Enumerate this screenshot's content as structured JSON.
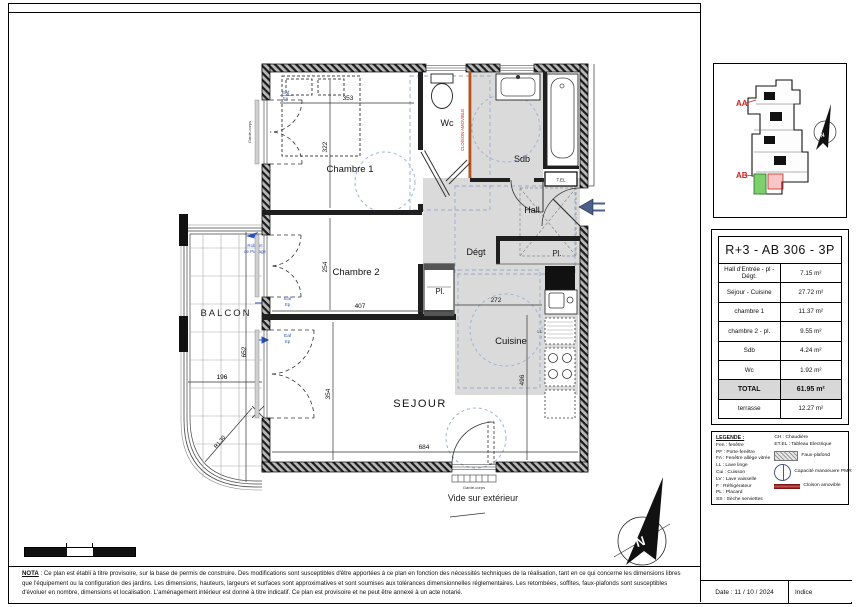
{
  "plan": {
    "rooms": {
      "chambre1": "Chambre 1",
      "chambre2": "Chambre 2",
      "wc": "Wc",
      "sdb": "Sdb",
      "hall": "Hall",
      "degt": "Dégt",
      "cuisine": "Cuisine",
      "sejour": "SEJOUR",
      "balcon": "BALCON",
      "placard": "Pl."
    },
    "dims": {
      "d353": "353",
      "d322": "322",
      "d254": "254",
      "d407": "407",
      "d272": "272",
      "d496": "496",
      "d354": "354",
      "d684": "684",
      "d652": "652",
      "d196": "196",
      "radius": "R1.30"
    },
    "annotations": {
      "vide": "Vide sur extérieur",
      "garde_corps": "Garde-corps",
      "cloison": "CLOISON AMOVIBLE",
      "robinet_l1": "Robinet",
      "robinet_l2": "de Puisage",
      "eaf": "Eaf",
      "ep": "Ep",
      "tel": "T.EL",
      "ll": "LL",
      "north": "N"
    }
  },
  "key_plan": {
    "aa": "AA",
    "ab": "AB",
    "north": "N"
  },
  "unit_table": {
    "title": "R+3 - AB 306 - 3P",
    "rows": [
      {
        "label": "Hall d'Entrée - pl - Dégt.",
        "value": "7.15 m²"
      },
      {
        "label": "Séjour - Cuisine",
        "value": "27.72 m²"
      },
      {
        "label": "chambre 1",
        "value": "11.37 m²"
      },
      {
        "label": "chambre 2 - pl.",
        "value": "9.55 m²"
      },
      {
        "label": "Sdb",
        "value": "4.24 m²"
      },
      {
        "label": "Wc",
        "value": "1.92 m²"
      },
      {
        "label": "TOTAL",
        "value": "61.95 m²"
      },
      {
        "label": "terrasse",
        "value": "12.27 m²"
      }
    ]
  },
  "legend": {
    "heading": "LEGENDE :",
    "items_left": [
      "Fen : fenêtre",
      "PF : Porte-fenêtre",
      "FA : Fenêtre allège vitrée",
      "LL : Lave linge",
      "Cui : Cuisson",
      "LV : Lave vaisselle",
      "F : Réfrigérateur",
      "PL : Placard",
      "SS : Sèche serviettes"
    ],
    "items_right": [
      "CH : Chaudière",
      "ET.EL : Tableau Electrique"
    ],
    "faux_plafond": "Faux-plafond",
    "pmr": "Capacité manoeuvre PMR",
    "cloison": "Cloison amovible"
  },
  "nota": {
    "label": "NOTA",
    "text": " : Ce plan est établi à titre provisoire, sur la base de permis de construire. Des modifications sont susceptibles d'être apportées à ce plan en fonction des nécessités techniques de la réalisation, tant en ce qui concerne les dimensions libres que l'équipement ou la configuration des jardins. Les dimensions, hauteurs, largeurs et surfaces sont approximatives et sont soumises aux tolérances dimensionnelles réglementaires. Les retombées, soffites, faux-plafonds sont susceptibles d'évoluer en nombre, dimensions et localisation. L'aménagement intérieur est donné à titre indicatif. Ce plan est provisoire et ne peut être annexé à un acte notarié."
  },
  "footer": {
    "date": "Date : 11 / 10 / 2024",
    "indice": "Indice"
  },
  "colors": {
    "accent_red": "#cc2222",
    "accent_blue": "#2a52be",
    "unit_green": "#7ed06d",
    "partition_brown": "#b5541e"
  }
}
